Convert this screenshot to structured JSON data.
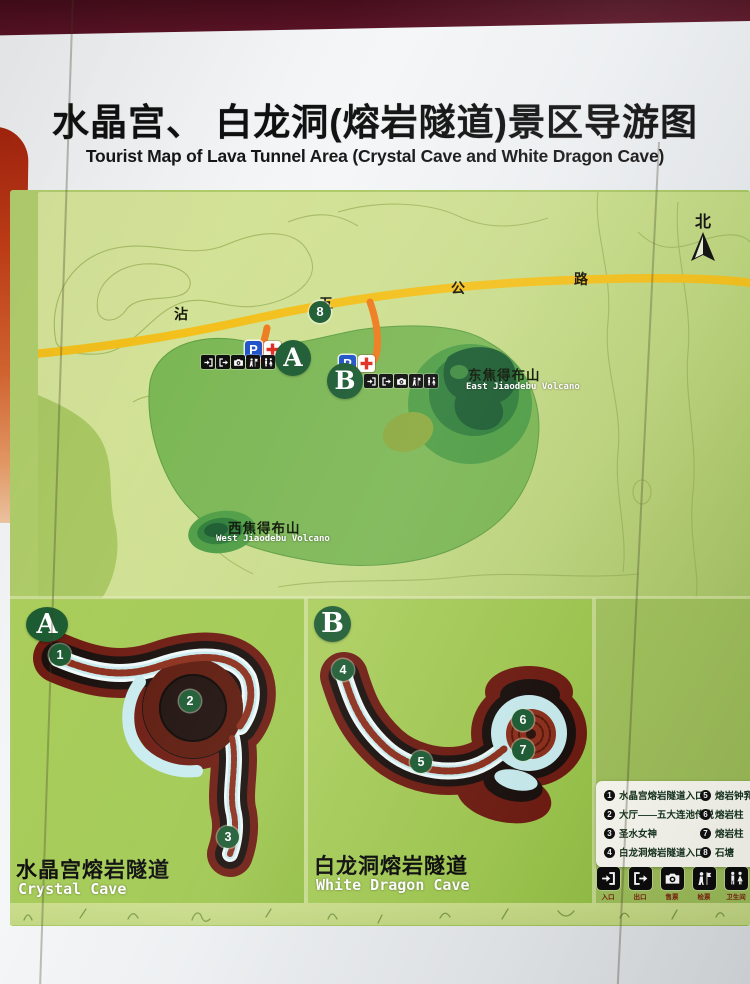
{
  "title": {
    "zh": "水晶宫、 白龙洞(熔岩隧道)景区导游图",
    "en": "Tourist Map of Lava Tunnel Area (Crystal Cave and White Dragon Cave)"
  },
  "compass": {
    "label": "北"
  },
  "road": {
    "name_chars": [
      "沾",
      "五",
      "公",
      "路"
    ],
    "spot_number": "8"
  },
  "map": {
    "marker_a": "A",
    "marker_b": "B",
    "parking_label": "P"
  },
  "volcanoes": {
    "east": {
      "zh": "东焦得布山",
      "en": "East Jiaodebu Volcano"
    },
    "west": {
      "zh": "西焦得布山",
      "en": "West Jiaodebu Volcano"
    }
  },
  "panel_a": {
    "letter": "A",
    "points": [
      "1",
      "2",
      "3"
    ],
    "caption_zh": "水晶宫熔岩隧道",
    "caption_en": "Crystal Cave"
  },
  "panel_b": {
    "letter": "B",
    "points": [
      "4",
      "5",
      "6",
      "7"
    ],
    "caption_zh": "白龙洞熔岩隧道",
    "caption_en": "White Dragon Cave"
  },
  "legend": {
    "left": [
      {
        "num": "1",
        "text": "水晶宫熔岩隧道入口"
      },
      {
        "num": "2",
        "text": "大厅——五大连池传说"
      },
      {
        "num": "3",
        "text": "圣水女神"
      },
      {
        "num": "4",
        "text": "白龙洞熔岩隧道入口"
      }
    ],
    "right": [
      {
        "num": "5",
        "text": "熔岩钟乳、熔"
      },
      {
        "num": "6",
        "text": "熔岩柱"
      },
      {
        "num": "7",
        "text": "熔岩柱"
      },
      {
        "num": "8",
        "text": "石塘"
      }
    ]
  },
  "facilities": [
    {
      "label": "入口",
      "icon": "entrance-icon"
    },
    {
      "label": "出口",
      "icon": "exit-icon"
    },
    {
      "label": "售票",
      "icon": "ticket-icon"
    },
    {
      "label": "检票",
      "icon": "ticket-check-icon"
    },
    {
      "label": "卫生间",
      "icon": "restroom-icon"
    },
    {
      "label": "停车场",
      "icon": "parking-icon"
    }
  ],
  "colors": {
    "board_green": "#a9c863",
    "terrain_green": "#cfe092",
    "road_yellow": "#f3c01c",
    "branch_orange": "#ee7b1e",
    "badge_green": "#1d5c33",
    "parking_blue": "#1d52c8",
    "cross_red": "#e02b1e",
    "cave_outer_red": "#6e1c12",
    "cave_channel_blue": "#cfeef0"
  }
}
